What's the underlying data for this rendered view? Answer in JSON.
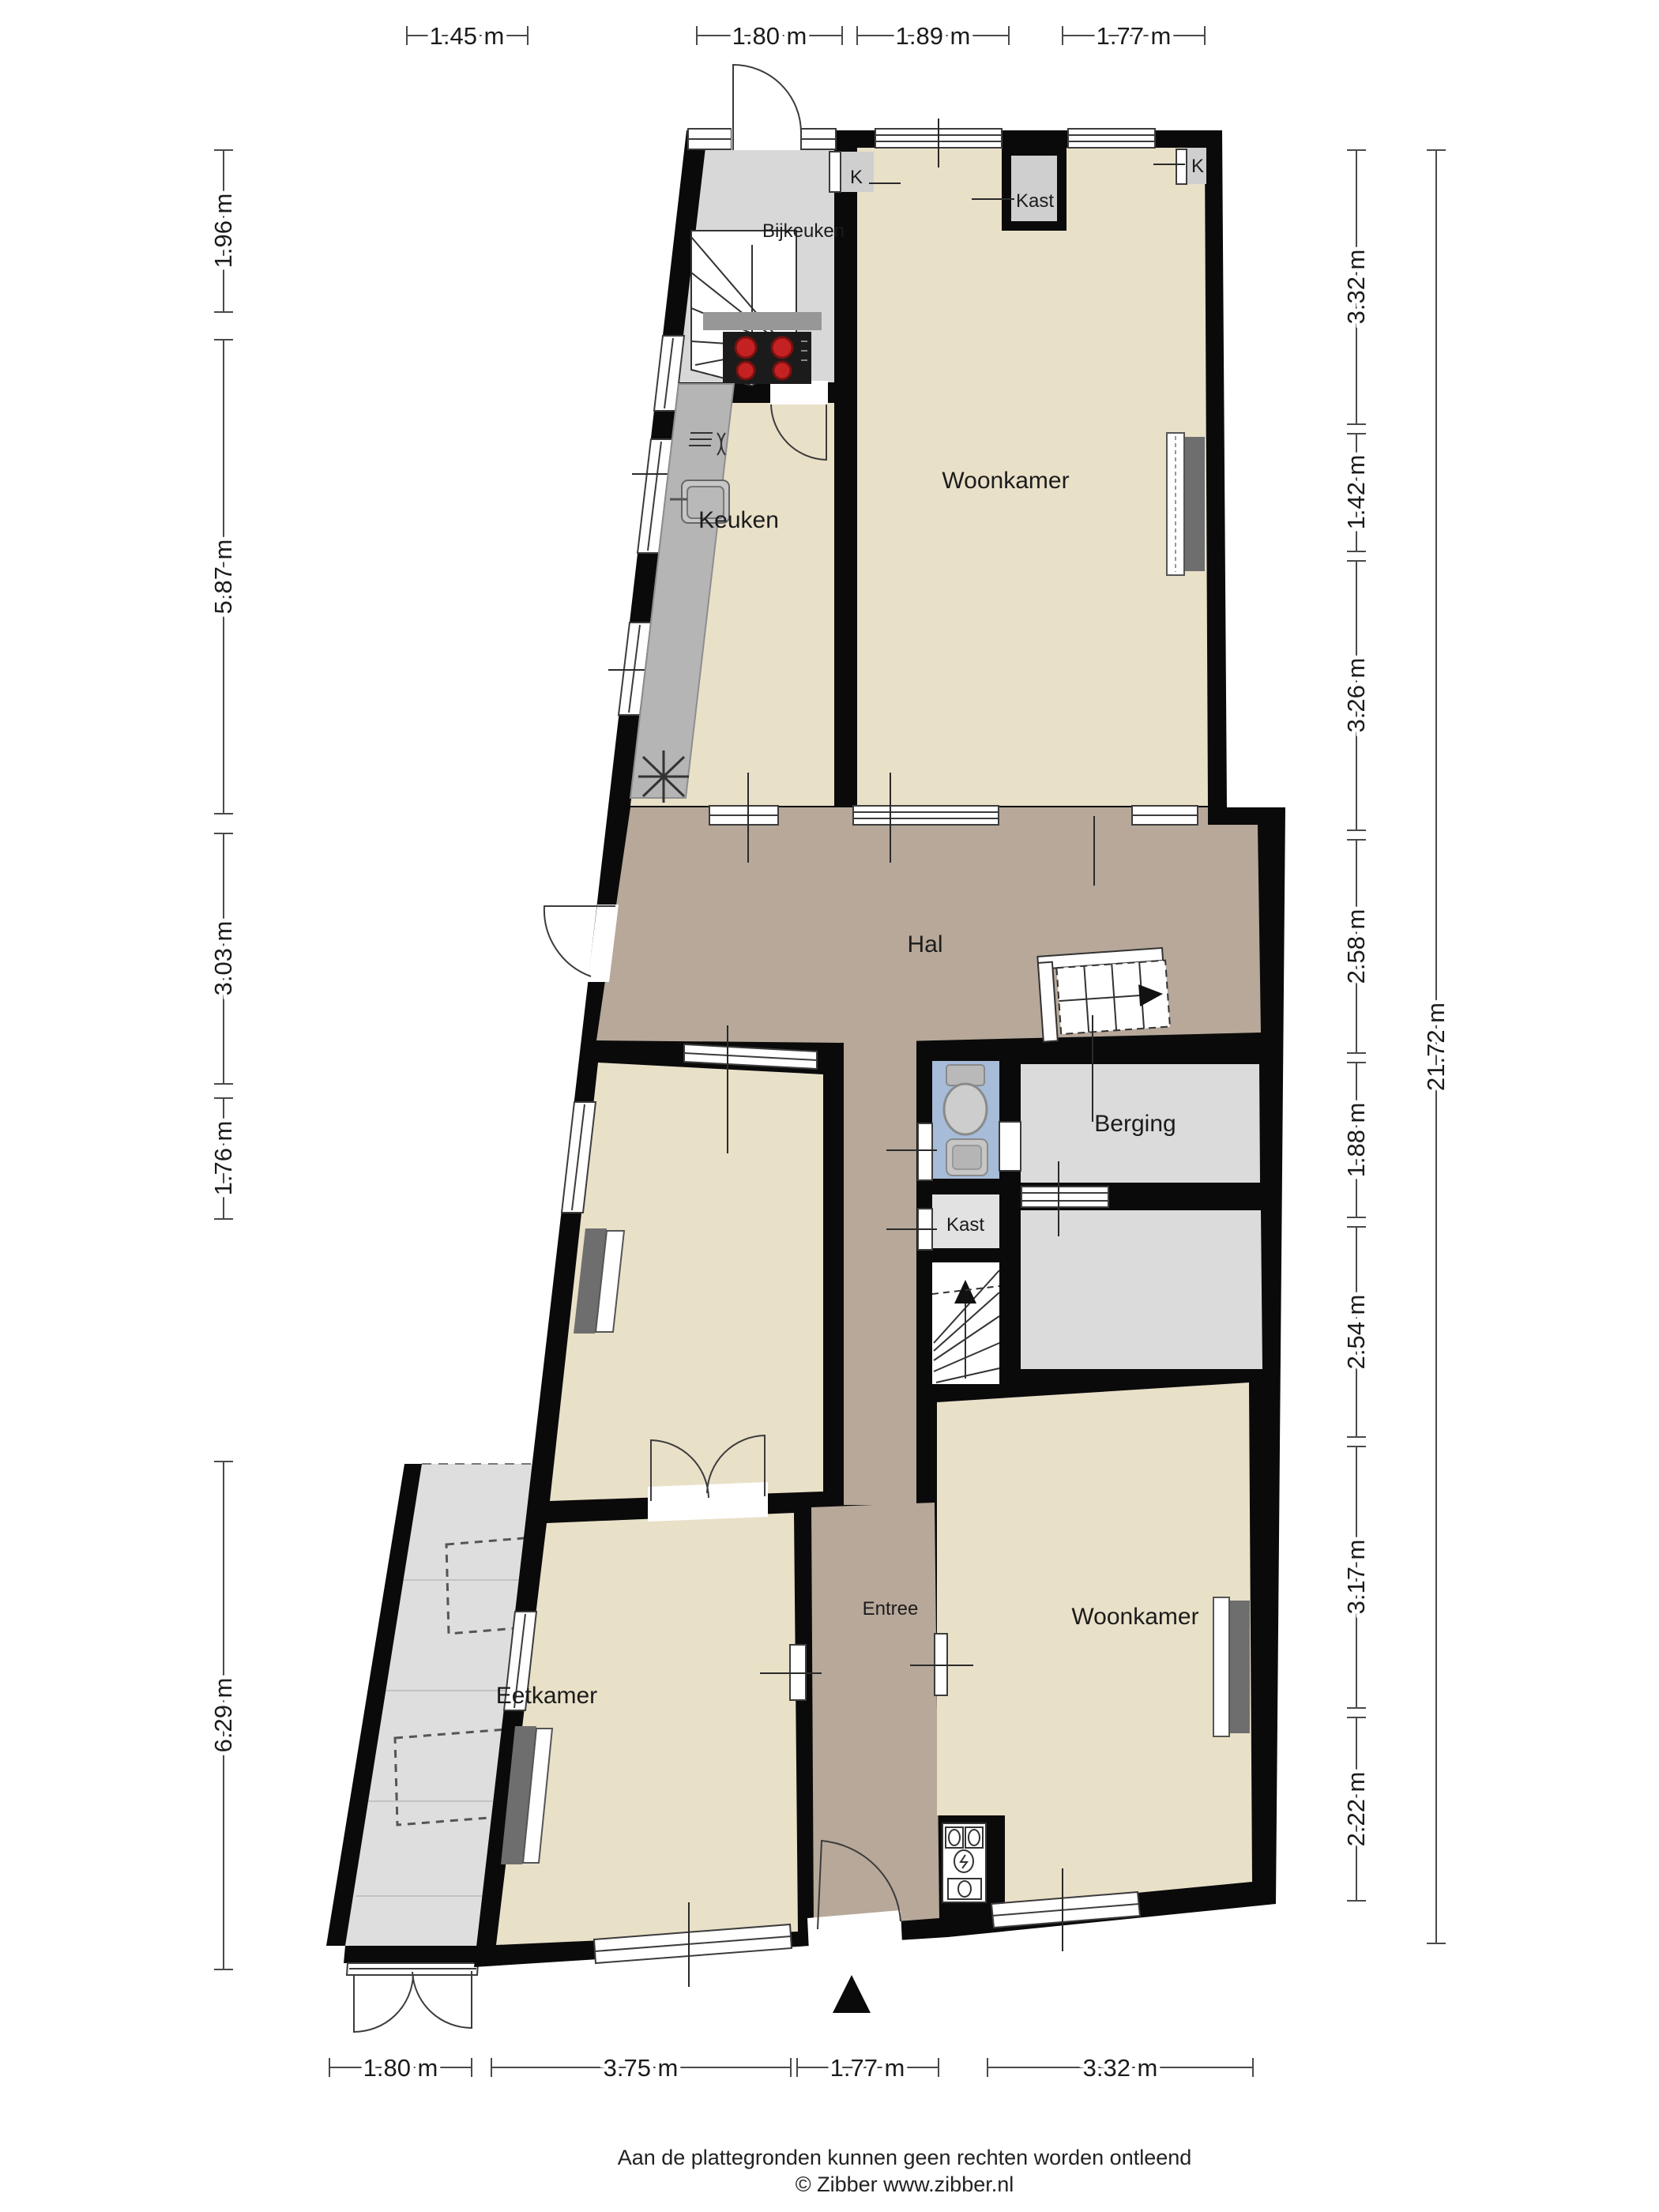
{
  "plan": {
    "title_hidden": "",
    "rooms": {
      "bijkeuken": "Bijkeuken",
      "woonkamer_top": "Woonkamer",
      "keuken": "Keuken",
      "hal": "Hal",
      "berging": "Berging",
      "kast_klein": "Kast",
      "kast_boven": "Kast",
      "k_links": "K",
      "k_rechts": "K",
      "entree": "Entree",
      "eetkamer": "Eetkamer",
      "woonkamer_onder": "Woonkamer"
    },
    "dimensions": {
      "top": [
        "1.45 m",
        "1.80 m",
        "1.89 m",
        "1.77 m"
      ],
      "left": [
        "1.96 m",
        "5.87 m",
        "3.03 m",
        "1.76 m",
        "6.29 m"
      ],
      "right": [
        "3.32 m",
        "1.42 m",
        "3.26 m",
        "2.58 m",
        "1.88 m",
        "2.54 m",
        "3.17 m",
        "2.22 m"
      ],
      "right_total": "21.72 m",
      "bottom": [
        "1.80 m",
        "3.75 m",
        "1.77 m",
        "3.32 m"
      ]
    },
    "footer": {
      "disclaimer": "Aan de plattegronden kunnen geen rechten worden ontleend",
      "copyright": "© Zibber www.zibber.nl"
    },
    "icons": {
      "north_arrow": "north-arrow",
      "stairs_up": "stairs-up-icon",
      "stairs_down": "stairs-down-icon",
      "toilet": "toilet-icon",
      "sink": "sink-icon",
      "cooktop": "cooktop-icon",
      "extractor": "extractor-fan-icon",
      "radiator": "radiator-icon",
      "meters": "utility-meters-icon"
    },
    "colors": {
      "wall": "#0a0a0a",
      "floor_beige": "#e9e0c8",
      "floor_taupe": "#b7a899",
      "floor_gray": "#d8d8d8",
      "floor_blue": "#a6bcd8",
      "terrace": "#dedede",
      "counter": "#b5b5b5",
      "burner": "#c42222"
    }
  }
}
